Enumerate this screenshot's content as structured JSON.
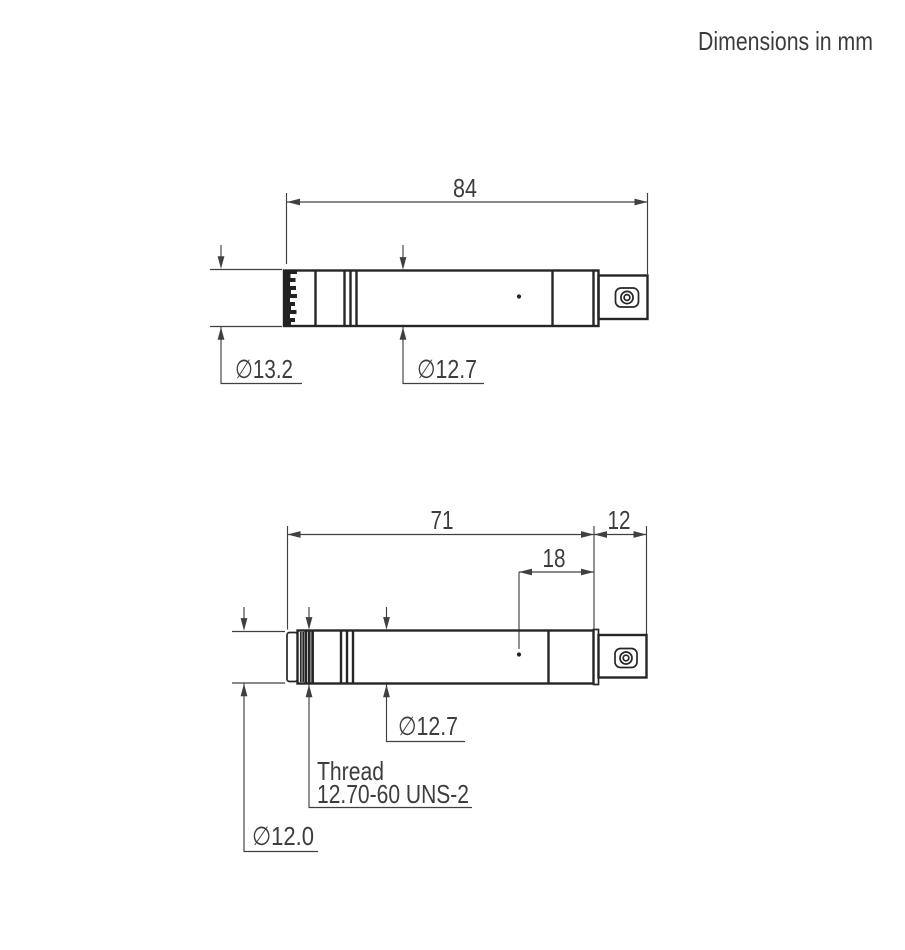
{
  "note": "Dimensions in mm",
  "colors": {
    "background": "#ffffff",
    "outline": "#262626",
    "dimension_lines": "#404040",
    "text": "#3d3d3d"
  },
  "top_view": {
    "overall_length": "84",
    "grid_diameter": "∅13.2",
    "body_diameter": "∅12.7"
  },
  "bottom_view": {
    "body_length": "71",
    "connector_length": "12",
    "vent_distance": "18",
    "body_diameter": "∅12.7",
    "thread_label": "Thread",
    "thread_spec": "12.70-60 UNS-2",
    "front_diameter": "∅12.0"
  }
}
